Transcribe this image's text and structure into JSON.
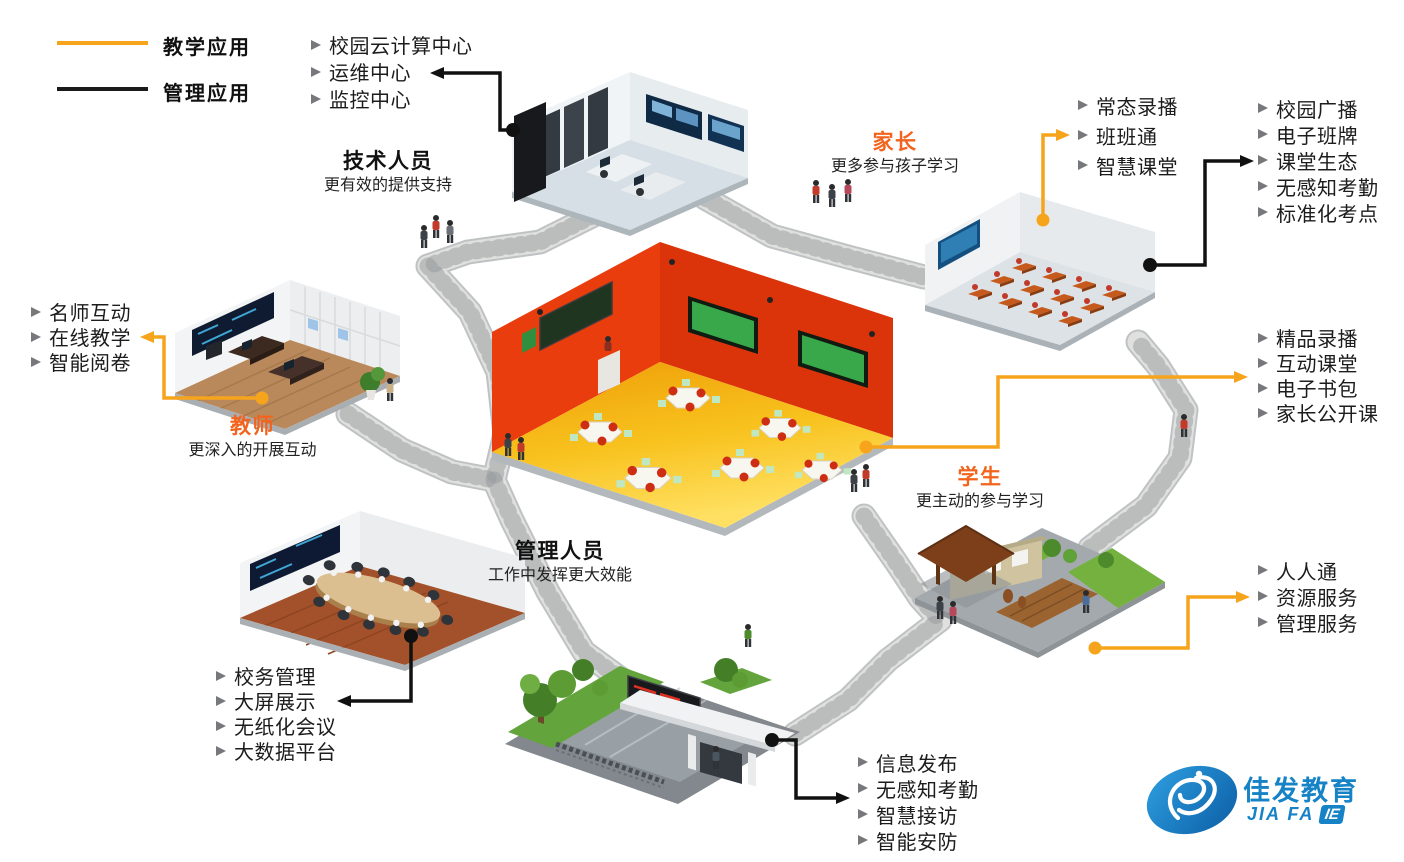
{
  "legend": {
    "teaching": {
      "label": "教学应用",
      "color": "#F7A41D"
    },
    "management": {
      "label": "管理应用",
      "color": "#1A1A1A"
    }
  },
  "roles": {
    "tech": {
      "title": "技术人员",
      "subtitle": "更有效的提供支持"
    },
    "parent": {
      "title": "家长",
      "subtitle": "更多参与孩子学习"
    },
    "teacher": {
      "title": "教师",
      "subtitle": "更深入的开展互动"
    },
    "admin": {
      "title": "管理人员",
      "subtitle": "工作中发挥更大效能"
    },
    "student": {
      "title": "学生",
      "subtitle": "更主动的参与学习"
    }
  },
  "lists": {
    "cloud": {
      "items": [
        "校园云计算中心",
        "运维中心",
        "监控中心"
      ]
    },
    "classroom_teaching": {
      "items": [
        "常态录播",
        "班班通",
        "智慧课堂"
      ]
    },
    "classroom_management": {
      "items": [
        "校园广播",
        "电子班牌",
        "课堂生态",
        "无感知考勤",
        "标准化考点"
      ]
    },
    "teacher": {
      "items": [
        "名师互动",
        "在线教学",
        "智能阅卷"
      ]
    },
    "student_teaching": {
      "items": [
        "精品录播",
        "互动课堂",
        "电子书包",
        "家长公开课"
      ]
    },
    "student_services": {
      "items": [
        "人人通",
        "资源服务",
        "管理服务"
      ]
    },
    "admin": {
      "items": [
        "校务管理",
        "大屏展示",
        "无纸化会议",
        "大数据平台"
      ]
    },
    "gate": {
      "items": [
        "信息发布",
        "无感知考勤",
        "智慧接访",
        "智能安防"
      ]
    }
  },
  "logo": {
    "name": "佳发教育",
    "sub": "JIA FA",
    "badge": "IE",
    "color": "#1583C6"
  },
  "icons": {
    "list_bullet": "gray right arrowhead",
    "connector_arrow": "filled triangle arrowhead",
    "connector_origin": "filled dot"
  },
  "colors": {
    "teaching_line": "#F7A41D",
    "management_line": "#1A1A1A",
    "role_highlight": "#F2641D",
    "logo_blue": "#1583C6"
  }
}
